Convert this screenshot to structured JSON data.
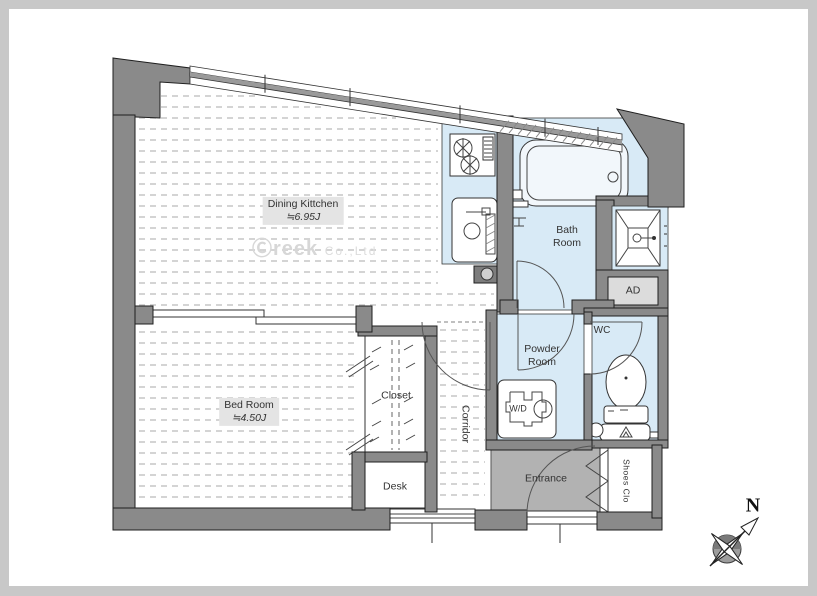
{
  "plan": {
    "rooms": {
      "dining_kitchen": {
        "name": "Dining Kittchen",
        "size": "≒6.95J"
      },
      "bath": {
        "line1": "Bath",
        "line2": "Room"
      },
      "bed": {
        "name": "Bed Room",
        "size": "≒4.50J"
      },
      "closet": {
        "name": "Closet"
      },
      "desk": {
        "name": "Desk"
      },
      "corridor": {
        "name": "Corridor"
      },
      "powder": {
        "line1": "Powder",
        "line2": "Room"
      },
      "wc": {
        "name": "WC"
      },
      "entrance": {
        "name": "Entrance"
      },
      "shoes": {
        "name": "Shoes Clo"
      }
    },
    "fixtures": {
      "washer": "W/D",
      "air_duct": "AD"
    },
    "compass": {
      "label": "N"
    },
    "watermark": {
      "logo": "Ⓒreek",
      "suffix": "Co.,Ltd"
    },
    "colors": {
      "wall": "#8a8a8a",
      "wall_stroke": "#1f1f1f",
      "wet_area": "#d8eaf6",
      "entrance_floor": "#b2b2b2",
      "floor_line": "#c6c6c6",
      "label_bg": "#e4e4e4",
      "text": "#333333"
    }
  }
}
